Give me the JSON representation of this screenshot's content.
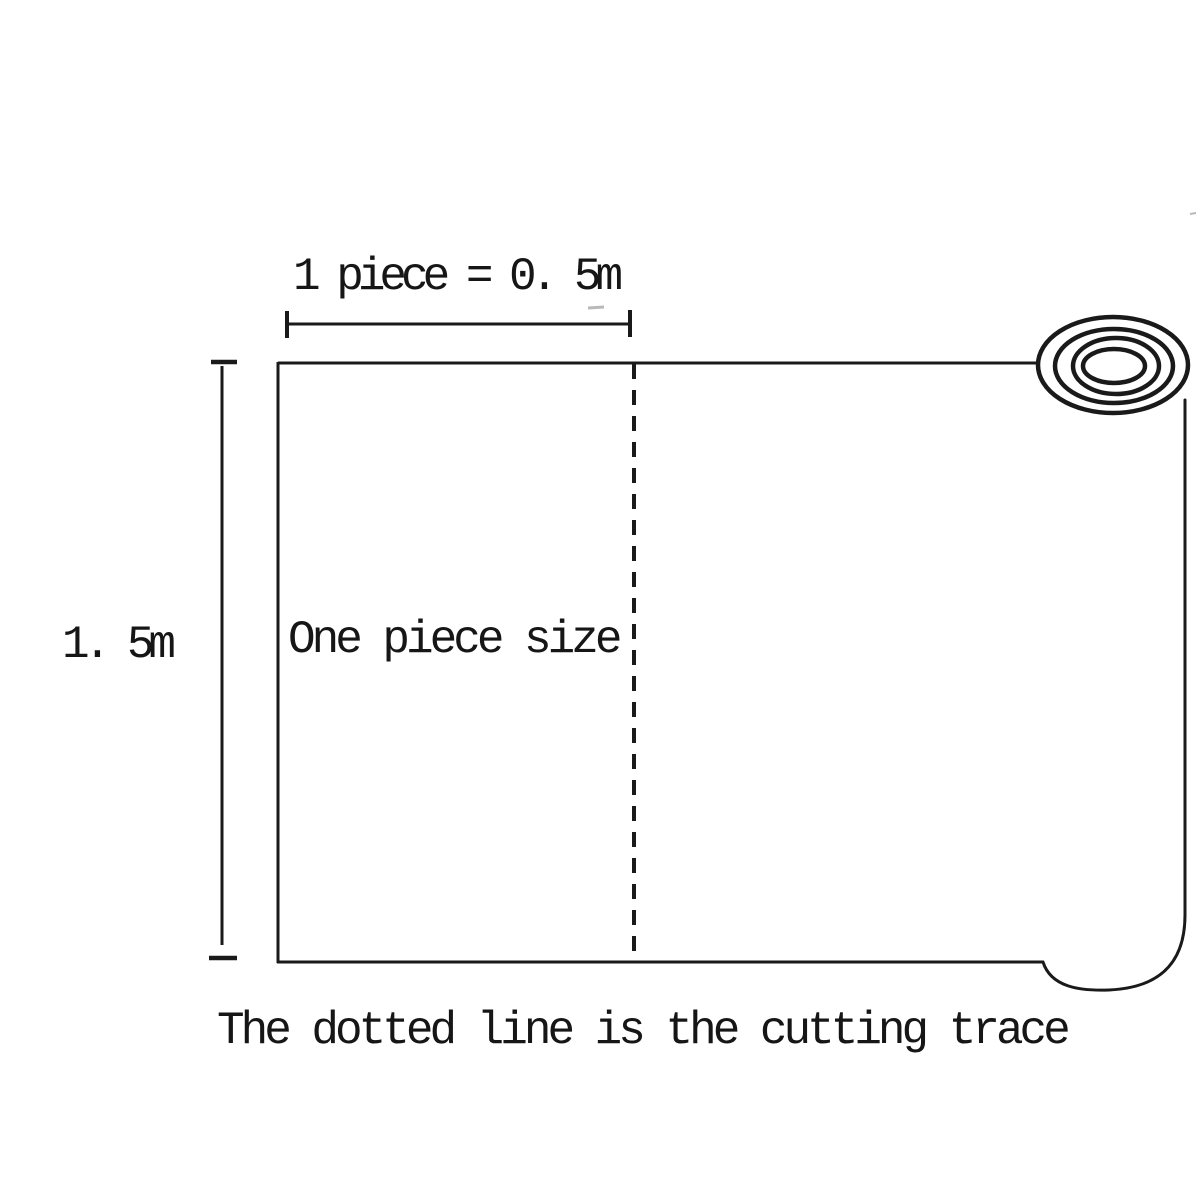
{
  "page": {
    "background_color": "#ffffff",
    "ink_color": "#1a1a1a"
  },
  "diagram": {
    "top_dimension": {
      "label": "1 piece = 0. 5m"
    },
    "left_dimension": {
      "label": "1. 5m"
    },
    "sheet": {
      "piece_label": "One piece size"
    },
    "caption": "The dotted line is the cutting trace",
    "icons": {
      "roll": "roll-end-icon"
    }
  }
}
